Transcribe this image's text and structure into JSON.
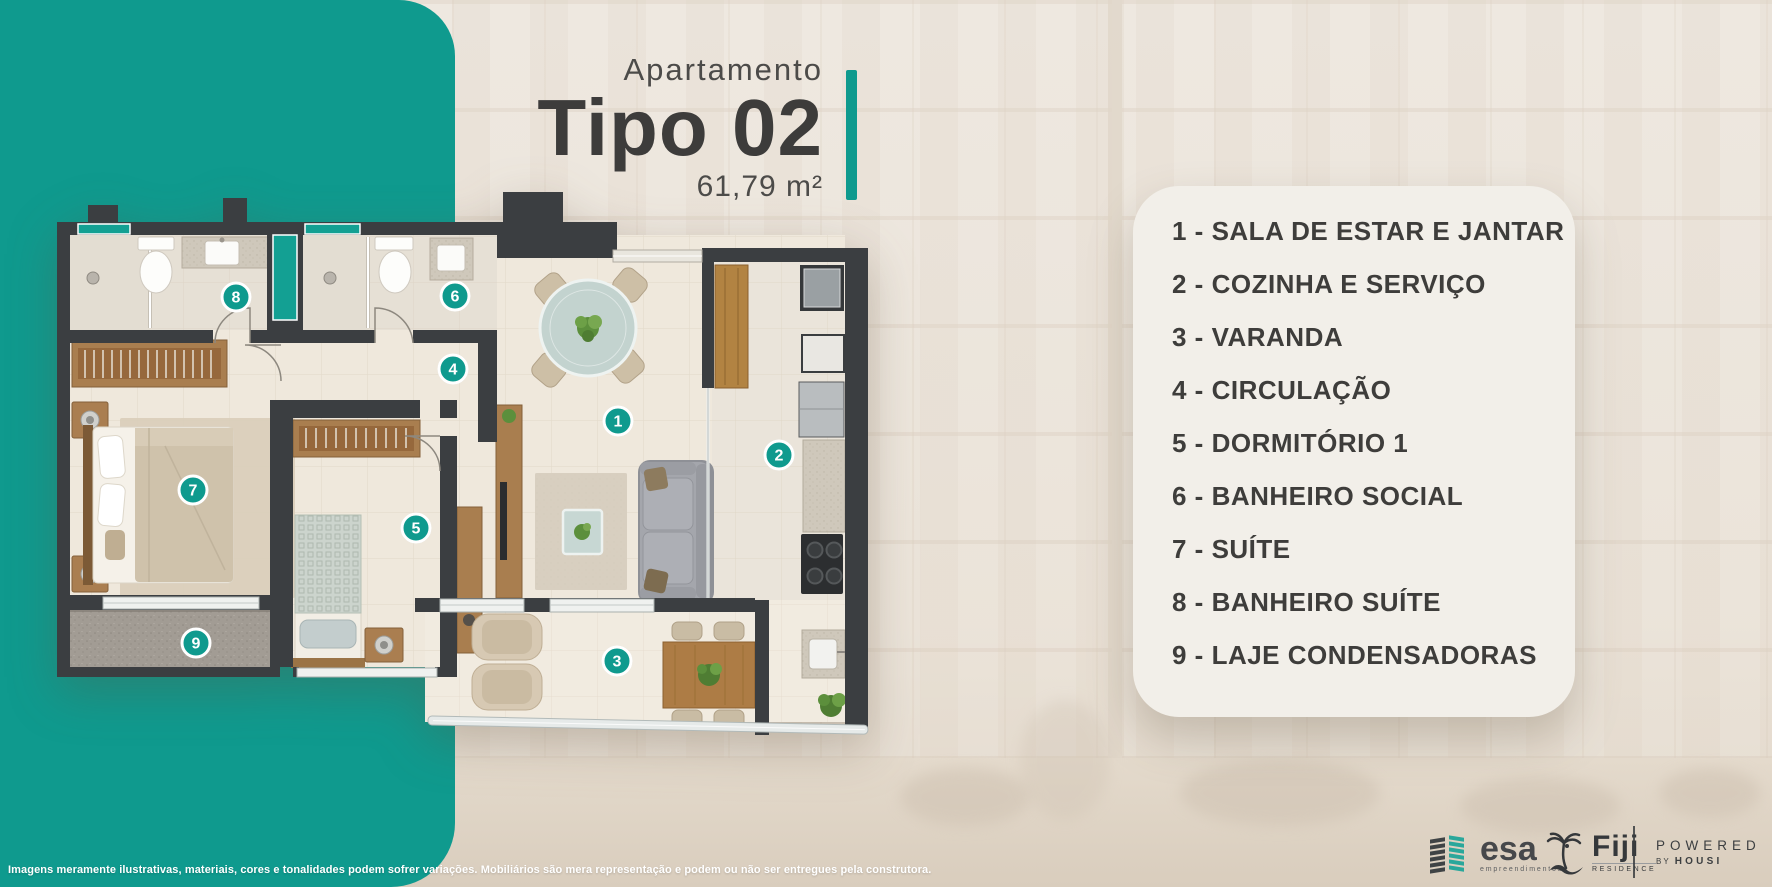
{
  "title": {
    "kicker": "Apartamento",
    "name": "Tipo 02",
    "area": "61,79 m²"
  },
  "legend": {
    "items": [
      "1 - SALA DE ESTAR E JANTAR",
      "2 - COZINHA E SERVIÇO",
      "3 - VARANDA",
      "4 - CIRCULAÇÃO",
      "5 - DORMITÓRIO 1",
      "6 - BANHEIRO SOCIAL",
      "7 - SUÍTE",
      "8 - BANHEIRO SUÍTE",
      "9 - LAJE CONDENSADORAS"
    ]
  },
  "plan": {
    "badges": [
      "1",
      "2",
      "3",
      "4",
      "5",
      "6",
      "7",
      "8",
      "9"
    ]
  },
  "disclaimer": "Imagens meramente ilustrativas, materiais, cores e tonalidades podem sofrer variações. Mobiliários são mera representação e podem ou não ser entregues pela construtora.",
  "footer": {
    "esa": {
      "name": "esa",
      "sub": "empreendimentos"
    },
    "fiji": {
      "name": "Fiji",
      "sub": "RESIDENCE"
    },
    "powered": {
      "line1": "POWERED",
      "by": "BY",
      "housi": "HOUSI"
    }
  },
  "colors": {
    "teal": "#0f9a8e",
    "teal_accent": "#13a093",
    "wall": "#3b3e41",
    "card_bg": "#f2efe9",
    "text_dark": "#3e3d3b"
  }
}
